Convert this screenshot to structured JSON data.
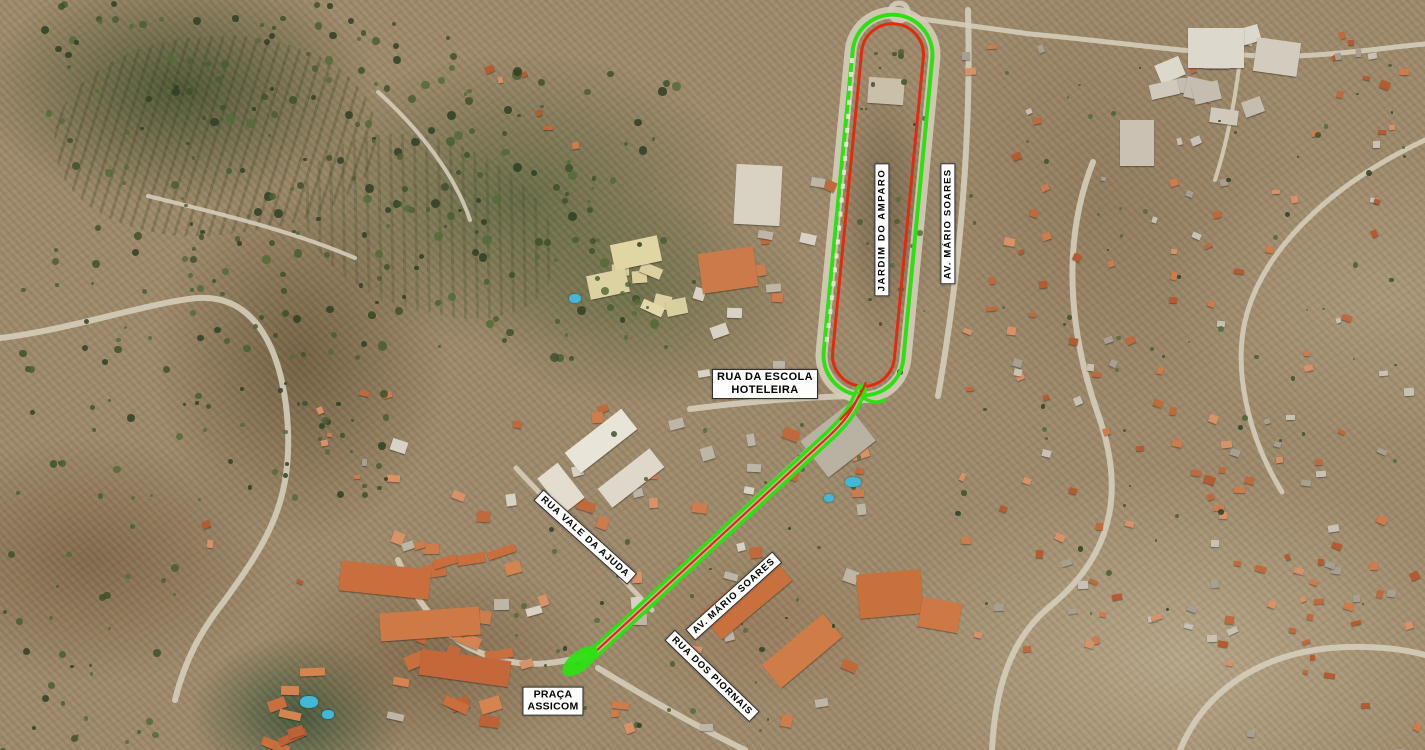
{
  "map": {
    "description": "Aerial orthophoto of the Amparo area with a highlighted route",
    "route_colors": {
      "primary_green": "#2ce012",
      "secondary_red": "#e02b10"
    },
    "labels": {
      "rua_escola": {
        "line1": "RUA DA ESCOLA",
        "line2": "HOTELEIRA"
      },
      "jardim_amparo": {
        "text": "JARDIM DO AMPARO"
      },
      "av_mario_soares_vertical": {
        "text": "AV. MÁRIO SOARES"
      },
      "rua_vale_ajuda": {
        "text": "RUA VALE DA AJUDA"
      },
      "av_mario_soares_diagonal": {
        "text": "AV. MÁRIO SOARES"
      },
      "rua_dos_piornais": {
        "text": "RUA DOS PIORNAIS"
      },
      "praca_assicom": {
        "line1": "PRAÇA",
        "line2": "ASSICOM"
      }
    }
  }
}
